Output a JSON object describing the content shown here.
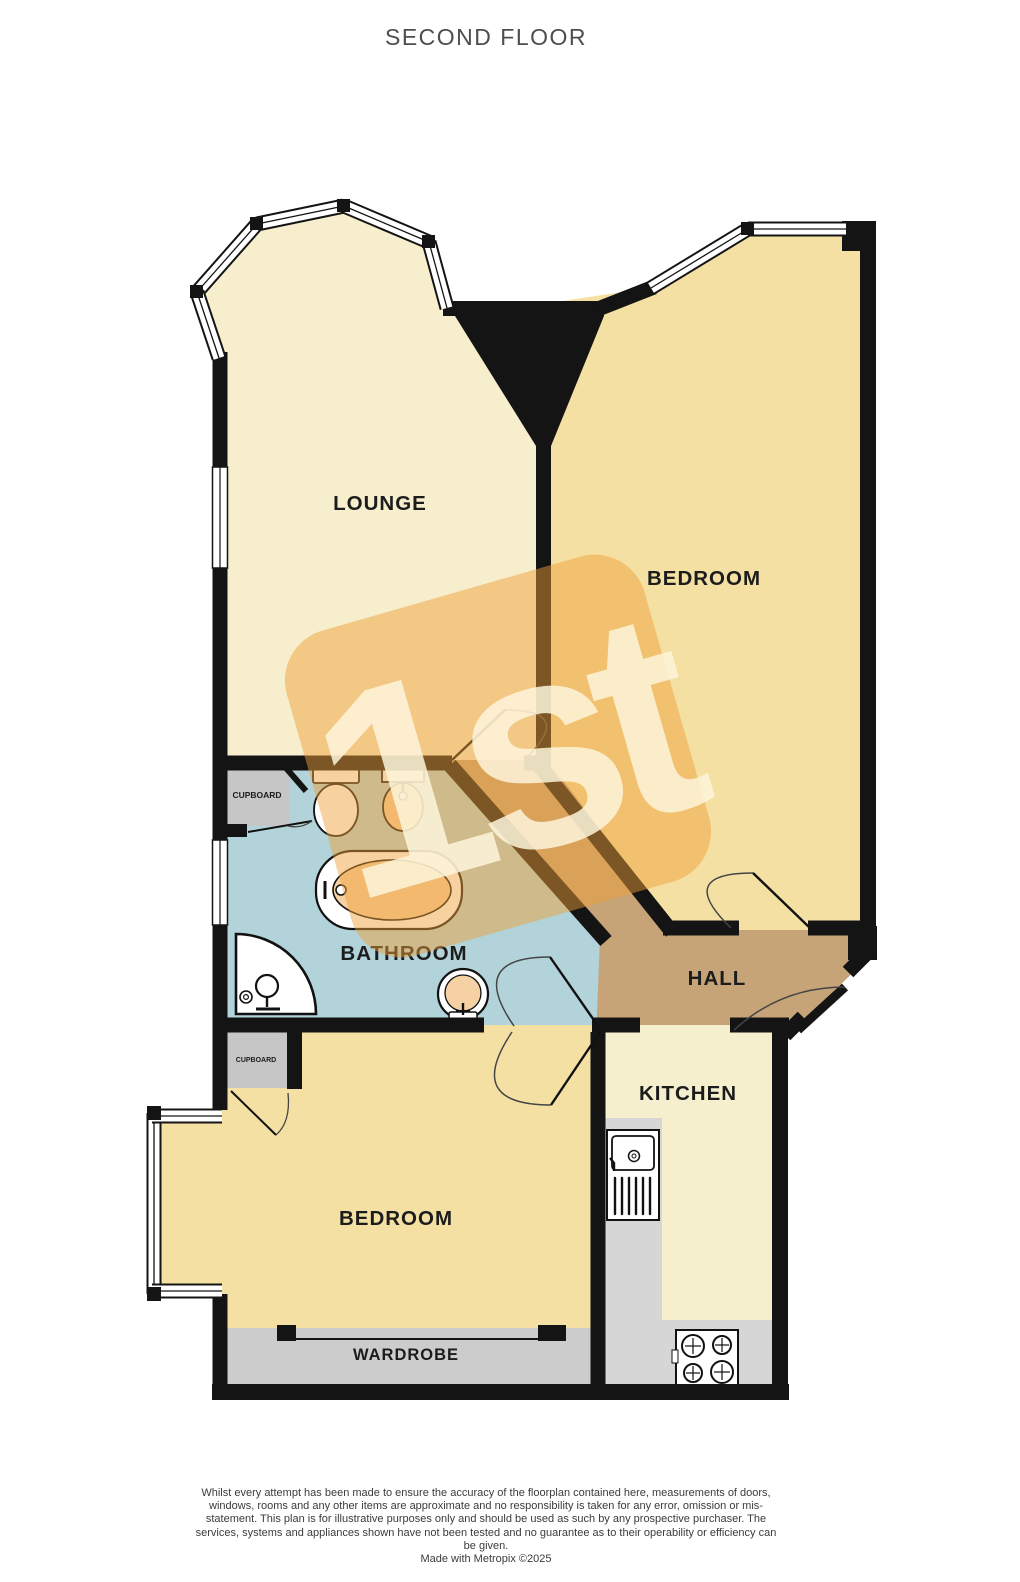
{
  "title": "SECOND FLOOR",
  "watermark": {
    "text": "1st"
  },
  "rooms": {
    "lounge": {
      "label": "LOUNGE"
    },
    "bedroom1": {
      "label": "BEDROOM"
    },
    "bathroom": {
      "label": "BATHROOM"
    },
    "hall": {
      "label": "HALL"
    },
    "kitchen": {
      "label": "KITCHEN"
    },
    "bedroom2": {
      "label": "BEDROOM"
    },
    "wardrobe": {
      "label": "WARDROBE"
    },
    "cupboard1": {
      "label": "CUPBOARD"
    },
    "cupboard2": {
      "label": "CUPBOARD"
    }
  },
  "fixtures": {
    "bathroom": [
      "toilet-icon",
      "basin-icon",
      "bath-icon",
      "corner-shower-icon",
      "pedestal-basin-icon"
    ],
    "kitchen": [
      "sink-drainer-icon",
      "hob-icon"
    ]
  },
  "colors": {
    "walls": "#141414",
    "lounge": "#f7eecd",
    "bedroom": "#f5e0a4",
    "bathroom": "#b2d3da",
    "hall": "#c7a478",
    "kitchen": "#f6efce",
    "cupboard": "#c6c6c6",
    "wardrobe": "#cccccc",
    "counter": "#d6d6d6",
    "fixture": "#f6d1a4",
    "watermark": "#ef9e36",
    "watermark_text": "#fdf4da",
    "label": "#1c1c1c",
    "title": "#4e4e4e",
    "footer": "#3b3b3b"
  },
  "footer": {
    "disclaimer": "Whilst every attempt has been made to ensure the accuracy of the floorplan contained here, measurements of doors, windows, rooms and any other items are approximate and no responsibility is taken for any error, omission or mis-statement. This plan is for illustrative purposes only and should be used as such by any prospective purchaser. The services, systems and appliances shown have not been tested and no guarantee as to their operability or efficiency can be given.",
    "credit": "Made with Metropix ©2025"
  }
}
